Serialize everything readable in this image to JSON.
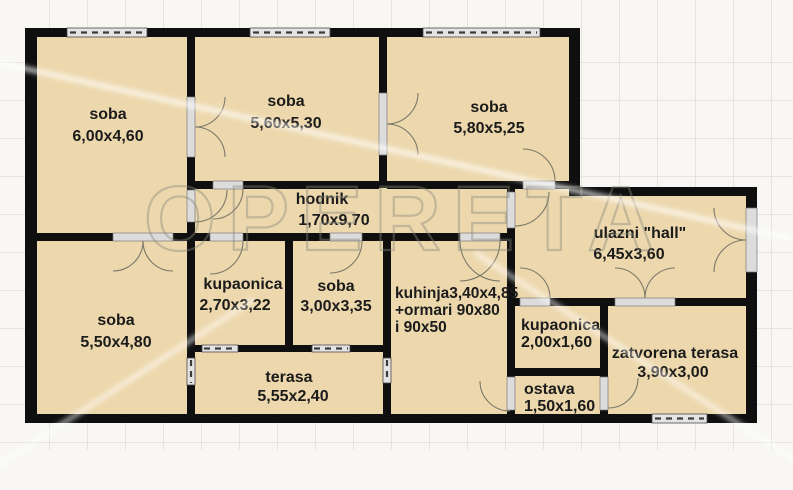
{
  "watermark": "OPERETA",
  "colors": {
    "floor": "#edd8ad",
    "wall": "#0f0f0f",
    "opening": "#dcdcdc",
    "window": "#e4e4e4",
    "label": "#1b1b1b",
    "watermark": "#89877d",
    "background": "#f8f7f4",
    "grid_line": "#e7e4de"
  },
  "plan": {
    "rooms": [
      {
        "name": "soba",
        "dims": "6,00x4,60"
      },
      {
        "name": "soba",
        "dims": "5,60x5,30"
      },
      {
        "name": "soba",
        "dims": "5,80x5,25"
      },
      {
        "name": "hodnik",
        "dims": "1,70x9,70"
      },
      {
        "name": "ulazni \"hall\"",
        "dims": "6,45x3,60"
      },
      {
        "name": "soba",
        "dims": "5,50x4,80"
      },
      {
        "name": "kupaonica",
        "dims": "2,70x3,22"
      },
      {
        "name": "soba",
        "dims": "3,00x3,35"
      },
      {
        "name": "kuhinja",
        "lines": [
          "kuhinja3,40x4,85",
          "+ormari 90x80",
          "i 90x50"
        ]
      },
      {
        "name": "terasa",
        "dims": "5,55x2,40"
      },
      {
        "name": "kupaonica",
        "dims": "2,00x1,60"
      },
      {
        "name": "ostava",
        "dims": "1,50x1,60"
      },
      {
        "name": "zatvorena terasa",
        "dims": "3,90x3,00"
      }
    ]
  }
}
